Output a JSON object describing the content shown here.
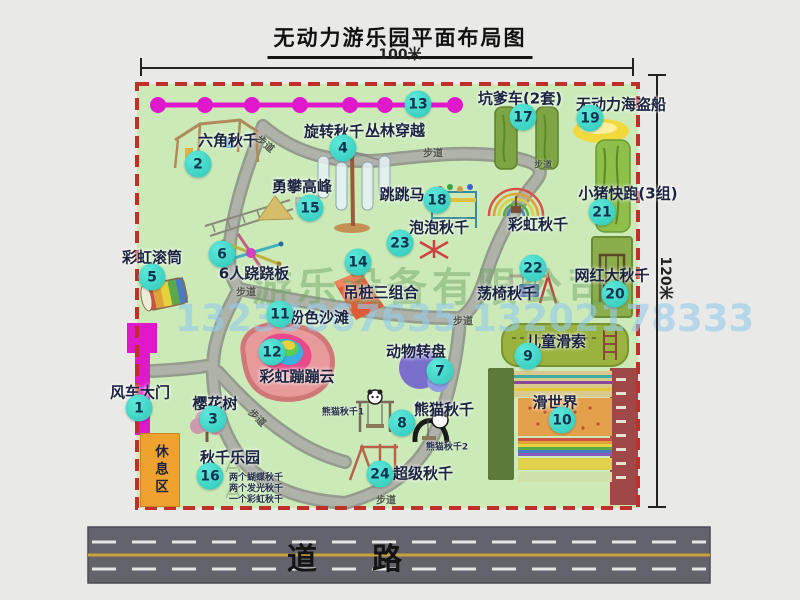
{
  "title": "无动力游乐园平面布局图",
  "dimensions": {
    "width_label": "100米",
    "height_label": "120米"
  },
  "watermark": {
    "company": "游乐设备有限公司",
    "phone": "13233867635 13202178333"
  },
  "road": {
    "label": "道路"
  },
  "rest_area": {
    "label": "休息区"
  },
  "path_label": "步道",
  "rainbow_swing_label": "彩虹秋千",
  "colors": {
    "park_green": "#cbeab8",
    "border_red": "#c03028",
    "badge_teal": "#2cc8ba",
    "zipline_magenta": "#e018cc",
    "road_gray": "#63636b",
    "rest_orange": "#f0a230"
  },
  "attractions": [
    {
      "num": "1",
      "label": "风车大门"
    },
    {
      "num": "2",
      "label": "六角秋千"
    },
    {
      "num": "3",
      "label": "樱花树"
    },
    {
      "num": "4",
      "label": "旋转秋千"
    },
    {
      "num": "5",
      "label": "彩虹滚筒"
    },
    {
      "num": "6",
      "label": "6人跷跷板"
    },
    {
      "num": "7",
      "label": "动物转盘"
    },
    {
      "num": "8",
      "label": "熊猫秋千",
      "sub1": "熊猫秋千1",
      "sub2": "熊猫秋千2"
    },
    {
      "num": "9",
      "label": "儿童滑索"
    },
    {
      "num": "10",
      "label": "滑世界"
    },
    {
      "num": "11",
      "label": "粉色沙滩"
    },
    {
      "num": "12",
      "label": "彩虹蹦蹦云"
    },
    {
      "num": "13",
      "label": "丛林穿越"
    },
    {
      "num": "14",
      "label": "吊桩三组合"
    },
    {
      "num": "15",
      "label": "勇攀高峰"
    },
    {
      "num": "16",
      "label": "秋千乐园",
      "subs": [
        "两个蝴蝶秋千",
        "两个发光秋千",
        "一个彩虹秋千"
      ]
    },
    {
      "num": "17",
      "label": "坑爹车(2套)"
    },
    {
      "num": "18",
      "label": "跳跳马"
    },
    {
      "num": "19",
      "label": "无动力海盗船"
    },
    {
      "num": "20",
      "label": "网红大秋千"
    },
    {
      "num": "21",
      "label": "小猪快跑(3组)"
    },
    {
      "num": "22",
      "label": "荡椅秋千"
    },
    {
      "num": "23",
      "label": "泡泡秋千"
    },
    {
      "num": "24",
      "label": "超级秋千"
    }
  ]
}
